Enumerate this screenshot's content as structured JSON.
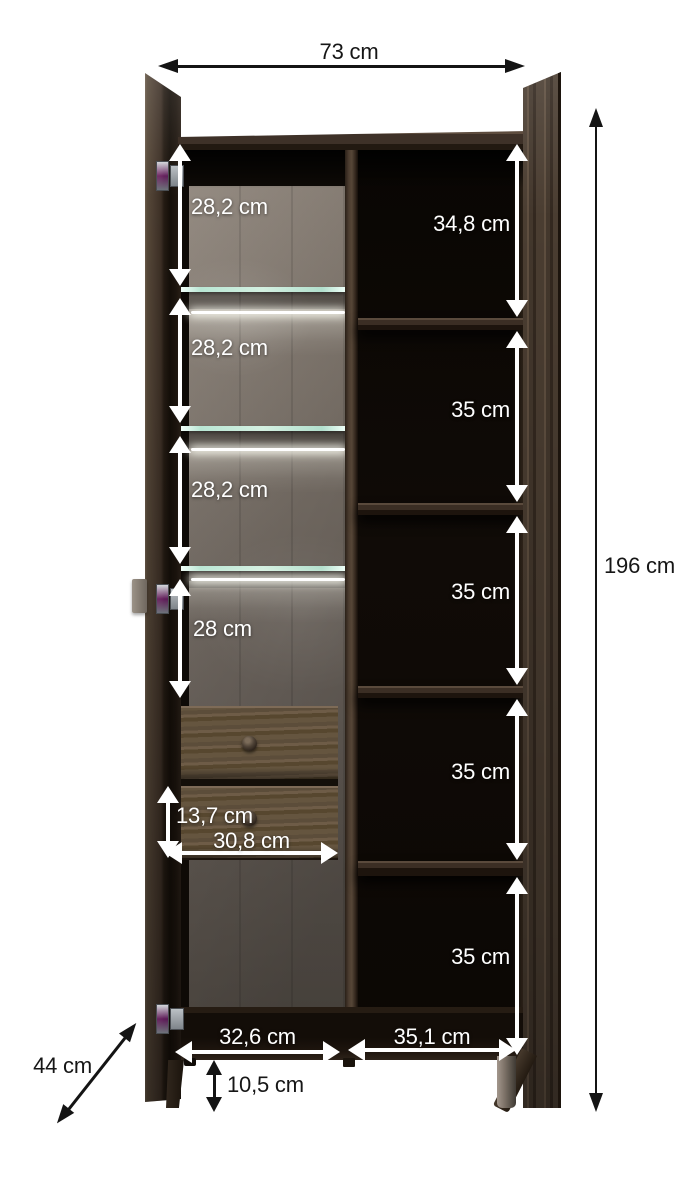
{
  "diagram": {
    "type": "furniture-dimension-diagram",
    "units": "cm",
    "labels": {
      "overall_width": "73 cm",
      "overall_height": "196 cm",
      "depth": "44 cm",
      "foot_height": "10,5 cm",
      "left_sections": [
        "28,2 cm",
        "28,2 cm",
        "28,2 cm",
        "28 cm"
      ],
      "right_sections": [
        "34,8 cm",
        "35 cm",
        "35 cm",
        "35 cm",
        "35 cm"
      ],
      "drawer_front_height": "13,7 cm",
      "drawer_width": "30,8 cm",
      "bottom_left_compartment_width": "32,6 cm",
      "bottom_right_compartment_width": "35,1 cm"
    },
    "values_cm": {
      "overall_width": 73,
      "overall_height": 196,
      "depth": 44,
      "foot_height": 10.5,
      "left_sections": [
        28.2,
        28.2,
        28.2,
        28
      ],
      "right_sections": [
        34.8,
        35,
        35,
        35,
        35
      ],
      "drawer_front_height": 13.7,
      "drawer_width": 30.8,
      "bottom_left_compartment_width": 32.6,
      "bottom_right_compartment_width": 35.1
    },
    "colors": {
      "background": "#ffffff",
      "dimension_dark_text": "#161616",
      "dimension_light_text": "#ffffff",
      "wood_dark": "#3a2e24",
      "wood_mid": "#5c4c3d",
      "interior_black": "#0e0a06",
      "back_panel_grey": "#7d746b",
      "glass_edge": "#d4f0e1",
      "led_white": "#ffffff"
    }
  }
}
